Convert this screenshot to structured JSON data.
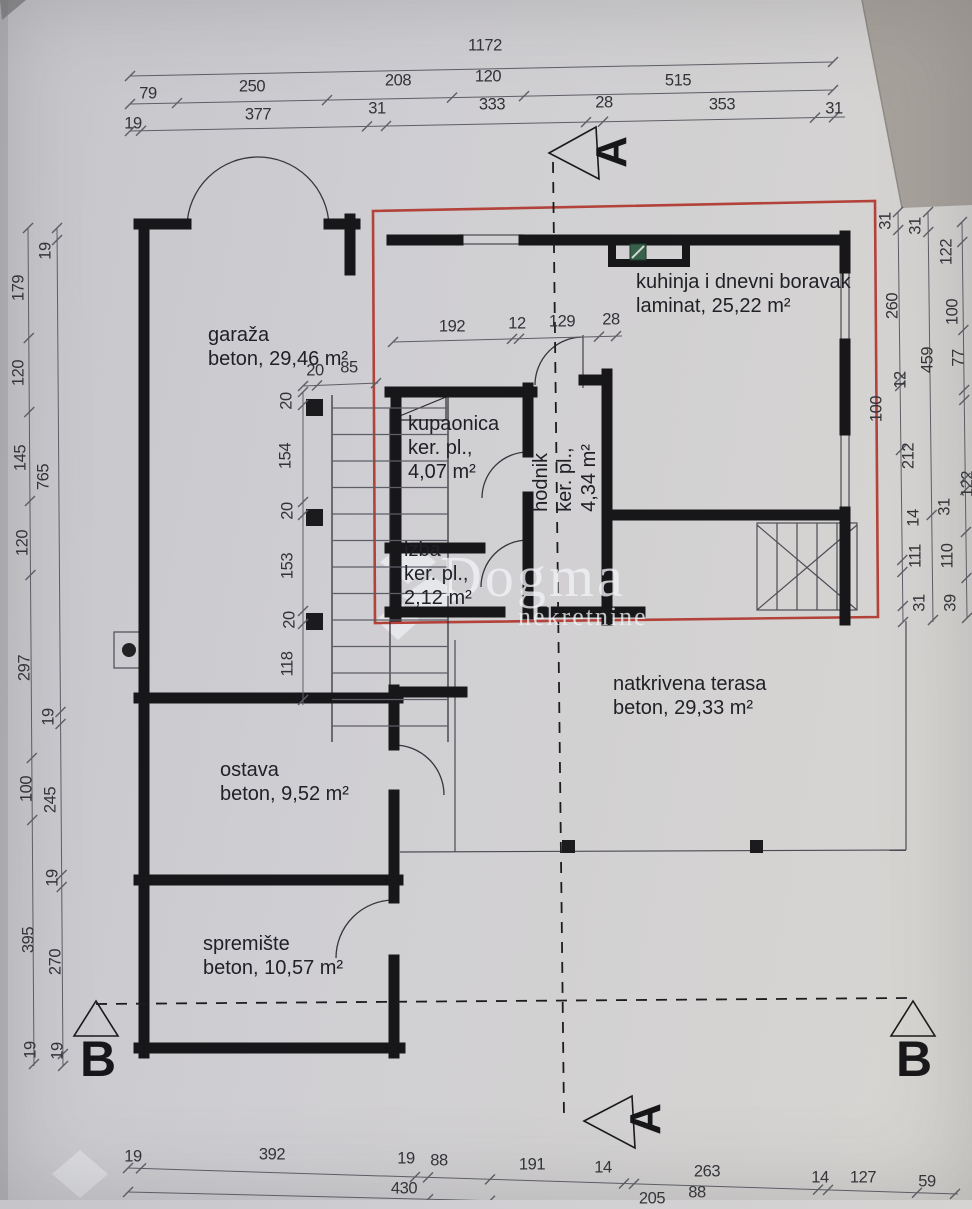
{
  "watermark": {
    "brand": "Dogma",
    "sub": "nekretnine"
  },
  "sections": {
    "a_top": "A",
    "a_bottom": "A",
    "b_left": "B",
    "b_right": "B"
  },
  "colors": {
    "paper": "#cfced2",
    "wall": "#17171a",
    "highlight_red": "#b2423a",
    "vent_green": "#39604a",
    "dim_text": "#323338"
  },
  "room_labels": [
    {
      "id": "garaza",
      "lines": [
        "garaža",
        "beton, 29,46 m²"
      ],
      "x": 208,
      "y": 323,
      "rot": 0
    },
    {
      "id": "kuhinja",
      "lines": [
        "kuhinja i dnevni boravak",
        "laminat, 25,22 m²"
      ],
      "x": 636,
      "y": 270,
      "rot": 0
    },
    {
      "id": "kupaonica",
      "lines": [
        "kupaonica",
        "ker. pl.,",
        "4,07 m²"
      ],
      "x": 408,
      "y": 412,
      "rot": 0
    },
    {
      "id": "hodnik",
      "lines": [
        "hodnik",
        "ker. pl.,",
        "4,34 m²"
      ],
      "x": 565,
      "y": 478,
      "rot": 1
    },
    {
      "id": "izba",
      "lines": [
        "izba",
        "ker. pl.,",
        "2,12 m²"
      ],
      "x": 404,
      "y": 538,
      "rot": 0
    },
    {
      "id": "terasa",
      "lines": [
        "natkrivena terasa",
        "beton, 29,33 m²"
      ],
      "x": 613,
      "y": 672,
      "rot": 0
    },
    {
      "id": "ostava",
      "lines": [
        "ostava",
        "beton, 9,52 m²"
      ],
      "x": 220,
      "y": 758,
      "rot": 0
    },
    {
      "id": "spremiste",
      "lines": [
        "spremište",
        "beton, 10,57 m²"
      ],
      "x": 203,
      "y": 932,
      "rot": 0
    }
  ],
  "dimension_labels": [
    {
      "t": "1172",
      "x": 485,
      "y": 46
    },
    {
      "t": "79",
      "x": 148,
      "y": 94
    },
    {
      "t": "250",
      "x": 252,
      "y": 87
    },
    {
      "t": "208",
      "x": 398,
      "y": 81
    },
    {
      "t": "120",
      "x": 488,
      "y": 77
    },
    {
      "t": "515",
      "x": 678,
      "y": 81
    },
    {
      "t": "19",
      "x": 133,
      "y": 124
    },
    {
      "t": "377",
      "x": 258,
      "y": 115
    },
    {
      "t": "31",
      "x": 377,
      "y": 109
    },
    {
      "t": "333",
      "x": 492,
      "y": 105
    },
    {
      "t": "28",
      "x": 604,
      "y": 103
    },
    {
      "t": "353",
      "x": 722,
      "y": 105
    },
    {
      "t": "31",
      "x": 834,
      "y": 109
    },
    {
      "t": "179",
      "x": 19,
      "y": 288,
      "r": 1
    },
    {
      "t": "120",
      "x": 19,
      "y": 373,
      "r": 1
    },
    {
      "t": "145",
      "x": 21,
      "y": 458,
      "r": 1
    },
    {
      "t": "120",
      "x": 23,
      "y": 543,
      "r": 1
    },
    {
      "t": "297",
      "x": 25,
      "y": 668,
      "r": 1
    },
    {
      "t": "100",
      "x": 27,
      "y": 789,
      "r": 1
    },
    {
      "t": "395",
      "x": 29,
      "y": 940,
      "r": 1
    },
    {
      "t": "19",
      "x": 31,
      "y": 1050,
      "r": 1
    },
    {
      "t": "19",
      "x": 46,
      "y": 251,
      "r": 1
    },
    {
      "t": "765",
      "x": 44,
      "y": 477,
      "r": 1
    },
    {
      "t": "19",
      "x": 49,
      "y": 717,
      "r": 1
    },
    {
      "t": "245",
      "x": 51,
      "y": 800,
      "r": 1
    },
    {
      "t": "19",
      "x": 53,
      "y": 878,
      "r": 1
    },
    {
      "t": "270",
      "x": 56,
      "y": 962,
      "r": 1
    },
    {
      "t": "19",
      "x": 58,
      "y": 1051,
      "r": 1
    },
    {
      "t": "31",
      "x": 886,
      "y": 221,
      "r": 1
    },
    {
      "t": "31",
      "x": 916,
      "y": 226,
      "r": 1
    },
    {
      "t": "122",
      "x": 947,
      "y": 252,
      "r": 1
    },
    {
      "t": "260",
      "x": 893,
      "y": 306,
      "r": 1
    },
    {
      "t": "100",
      "x": 953,
      "y": 312,
      "r": 1
    },
    {
      "t": "459",
      "x": 928,
      "y": 360,
      "r": 1
    },
    {
      "t": "77",
      "x": 959,
      "y": 358,
      "r": 1
    },
    {
      "t": "12",
      "x": 901,
      "y": 380,
      "r": 1
    },
    {
      "t": "100",
      "x": 877,
      "y": 409,
      "r": 1
    },
    {
      "t": "212",
      "x": 909,
      "y": 456,
      "r": 1
    },
    {
      "t": "122",
      "x": 968,
      "y": 484,
      "r": 1
    },
    {
      "t": "14",
      "x": 914,
      "y": 518,
      "r": 1
    },
    {
      "t": "31",
      "x": 945,
      "y": 507,
      "r": 1
    },
    {
      "t": "111",
      "x": 916,
      "y": 556,
      "r": 1
    },
    {
      "t": "110",
      "x": 948,
      "y": 556,
      "r": 1
    },
    {
      "t": "31",
      "x": 920,
      "y": 603,
      "r": 1
    },
    {
      "t": "39",
      "x": 951,
      "y": 603,
      "r": 1
    },
    {
      "t": "19",
      "x": 133,
      "y": 1157
    },
    {
      "t": "392",
      "x": 272,
      "y": 1155
    },
    {
      "t": "19",
      "x": 406,
      "y": 1159
    },
    {
      "t": "88",
      "x": 439,
      "y": 1161
    },
    {
      "t": "191",
      "x": 532,
      "y": 1165
    },
    {
      "t": "14",
      "x": 603,
      "y": 1168
    },
    {
      "t": "263",
      "x": 707,
      "y": 1172
    },
    {
      "t": "14",
      "x": 820,
      "y": 1178
    },
    {
      "t": "127",
      "x": 863,
      "y": 1178
    },
    {
      "t": "59",
      "x": 927,
      "y": 1182
    },
    {
      "t": "430",
      "x": 404,
      "y": 1189
    },
    {
      "t": "88",
      "x": 697,
      "y": 1193
    },
    {
      "t": "205",
      "x": 652,
      "y": 1199
    },
    {
      "t": "20",
      "x": 315,
      "y": 371
    },
    {
      "t": "85",
      "x": 349,
      "y": 368
    },
    {
      "t": "192",
      "x": 452,
      "y": 327
    },
    {
      "t": "12",
      "x": 517,
      "y": 324
    },
    {
      "t": "129",
      "x": 562,
      "y": 322
    },
    {
      "t": "28",
      "x": 611,
      "y": 320
    },
    {
      "t": "20",
      "x": 287,
      "y": 401,
      "r": 1
    },
    {
      "t": "154",
      "x": 286,
      "y": 456,
      "r": 1
    },
    {
      "t": "20",
      "x": 288,
      "y": 511,
      "r": 1
    },
    {
      "t": "153",
      "x": 288,
      "y": 566,
      "r": 1
    },
    {
      "t": "20",
      "x": 290,
      "y": 620,
      "r": 1
    },
    {
      "t": "118",
      "x": 288,
      "y": 664,
      "r": 1
    }
  ]
}
